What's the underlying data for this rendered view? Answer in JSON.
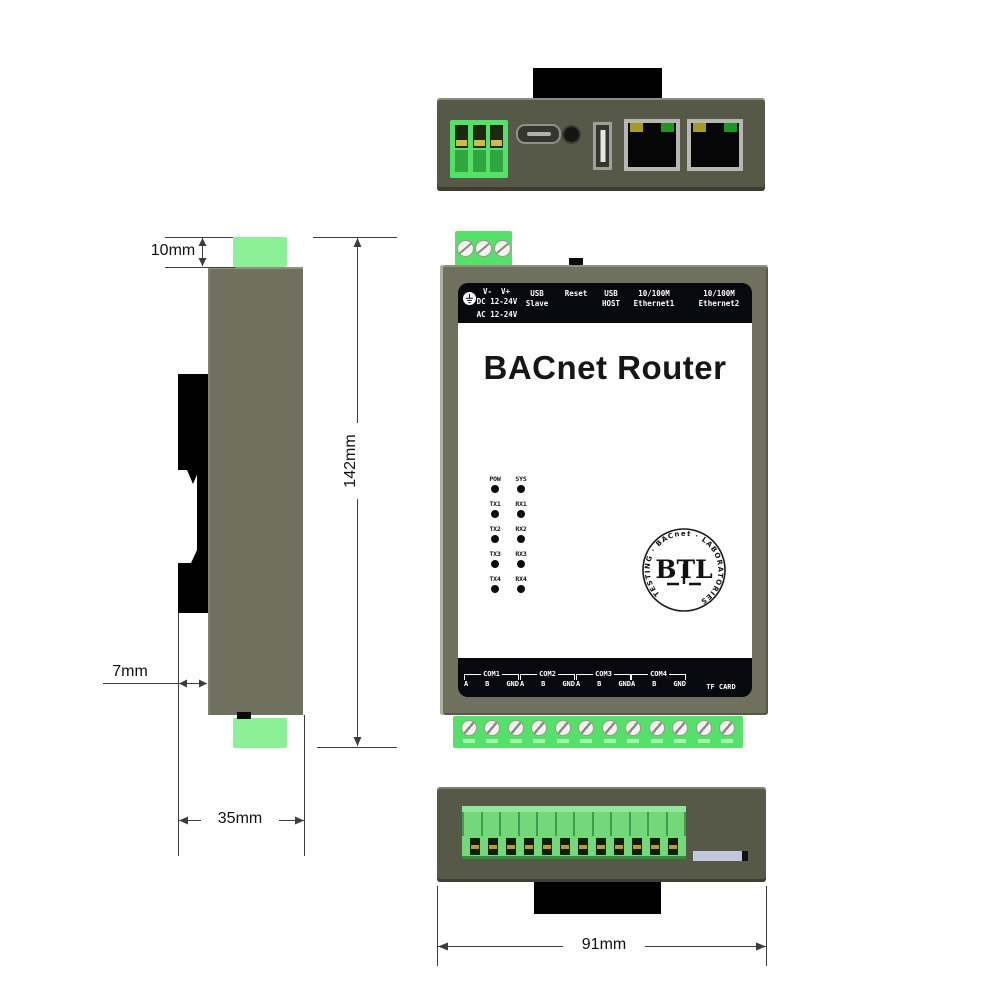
{
  "device": {
    "title": "BACnet Router",
    "top_strip": {
      "v_minus": "V-",
      "v_plus": "V+",
      "dc": "DC 12-24V",
      "ac": "AC 12-24V",
      "usb_slave": [
        "USB",
        "Slave"
      ],
      "reset": "Reset",
      "usb_host": [
        "USB",
        "HOST"
      ],
      "eth1": [
        "10/100M",
        "Ethernet1"
      ],
      "eth2": [
        "10/100M",
        "Ethernet2"
      ]
    },
    "leds": {
      "rows": [
        [
          "POW",
          "SYS"
        ],
        [
          "TX1",
          "RX1"
        ],
        [
          "TX2",
          "RX2"
        ],
        [
          "TX3",
          "RX3"
        ],
        [
          "TX4",
          "RX4"
        ]
      ]
    },
    "btl": {
      "ring": "TESTING · BACnet · LABORATORIES",
      "letters": "BTL"
    },
    "bottom_strip": {
      "com_groups": [
        {
          "name": "COM1",
          "pins": [
            "A",
            "B",
            "GND"
          ]
        },
        {
          "name": "COM2",
          "pins": [
            "A",
            "B",
            "GND"
          ]
        },
        {
          "name": "COM3",
          "pins": [
            "A",
            "B",
            "GND"
          ]
        },
        {
          "name": "COM4",
          "pins": [
            "A",
            "B",
            "GND"
          ]
        }
      ],
      "tf_card": "TF CARD"
    }
  },
  "dims": {
    "top_block": "10mm",
    "height": "142mm",
    "rail_offset": "7mm",
    "depth": "35mm",
    "width": "91mm"
  },
  "colors": {
    "body": "#6f715e",
    "body_dark": "#575948",
    "green": "#55e069",
    "green_light": "#8bf098",
    "strip": "#08080f",
    "panel": "#ffffff"
  }
}
